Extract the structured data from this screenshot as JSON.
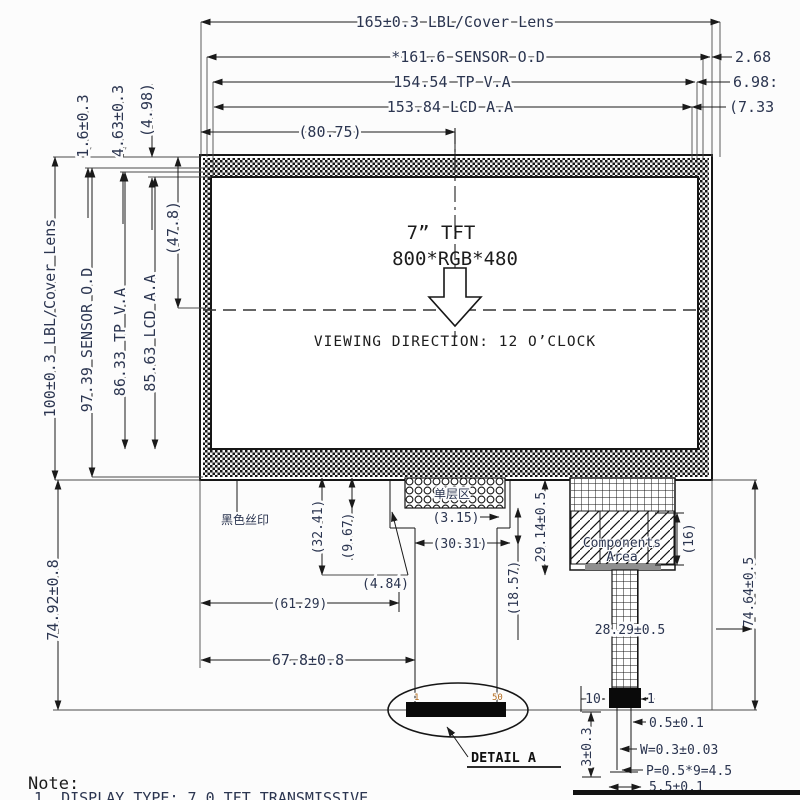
{
  "labels": {
    "dims_top": {
      "cover": "165±0.3 LBL/Cover Lens",
      "sensor": "*161.6 SENSOR O.D",
      "tp": "154.54 TP V.A",
      "lcd": "153.84 LCD A.A",
      "half": "(80.75)"
    },
    "dims_right": {
      "r1": "2.68",
      "r2": "6.98:",
      "r3": "(7.33"
    },
    "dims_left": {
      "l1": "1.6±0.3",
      "l2": "4.63±0.3",
      "l3": "(4.98)",
      "cover": "100±0.3 LBL/Cover Lens",
      "sensor": "97.39 SENSOR O.D",
      "tp": "86.33 TP V.A",
      "lcd": "85.63 LCD A.A",
      "half": "(47.8)",
      "lower": "74.92±0.8"
    },
    "screen": {
      "size": "7” TFT",
      "resolution": "800*RGB*480",
      "viewing": "VIEWING DIRECTION: 12 O’CLOCK"
    },
    "dims_bottom": {
      "silk": "黑色丝印",
      "single_layer": "单层区",
      "b1": "(32.41)",
      "b2": "(9.67)",
      "b3": "(3.15)",
      "b4": "(30.31)",
      "b5": "(4.84)",
      "b6": "(61.29)",
      "b7": "67.8±0.8",
      "b8": "(18.57)",
      "b9": "29.14±0.5",
      "b10": "(16)",
      "b11": "74.64±0.5",
      "b12": "28.29±0.5"
    },
    "components": {
      "line1": "Components",
      "line2": "Area"
    },
    "connector": {
      "pin_left": "10",
      "pin_right": "1",
      "c1": "0.5±0.1",
      "c2": "W=0.3±0.03",
      "c3": "P=0.5*9=4.5",
      "c4": "5.5±0.1",
      "c5": "3±0.3"
    },
    "detail": {
      "label": "DETAIL A",
      "pin_first": "1",
      "pin_last": "50"
    },
    "note": {
      "title": "Note:",
      "line1": "1. DISPLAY TYPE: 7.0 TFT TRANSMISSIVE"
    }
  },
  "colors": {
    "line": "#1a1a1a",
    "dim_text": "#2b3550",
    "pin_label": "#b06a1e",
    "background": "#fcfcfc"
  }
}
